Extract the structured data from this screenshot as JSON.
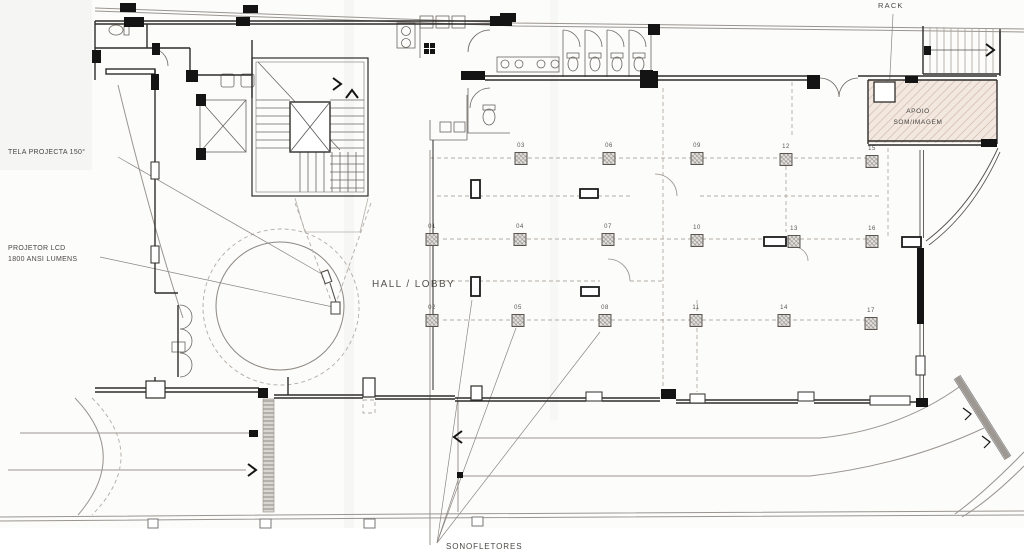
{
  "annotations": {
    "tela_projecta": "TELA PROJECTA 150°",
    "projetor_lcd": "PROJETOR LCD",
    "projetor_lumens": "1800 ANSI LUMENS",
    "hall_lobby": "HALL / LOBBY",
    "rack": "RACK",
    "apoio_line1": "APOIO",
    "apoio_line2": "SOM/IMAGEM",
    "sonofletores": "SONOFLETORES"
  },
  "speakers": [
    {
      "id": "01",
      "x": 432,
      "y": 239
    },
    {
      "id": "02",
      "x": 432,
      "y": 320
    },
    {
      "id": "03",
      "x": 521,
      "y": 158
    },
    {
      "id": "04",
      "x": 520,
      "y": 239
    },
    {
      "id": "05",
      "x": 518,
      "y": 320
    },
    {
      "id": "06",
      "x": 609,
      "y": 158
    },
    {
      "id": "07",
      "x": 608,
      "y": 239
    },
    {
      "id": "08",
      "x": 605,
      "y": 320
    },
    {
      "id": "09",
      "x": 697,
      "y": 158
    },
    {
      "id": "10",
      "x": 697,
      "y": 240
    },
    {
      "id": "11",
      "x": 696,
      "y": 320
    },
    {
      "id": "12",
      "x": 786,
      "y": 159
    },
    {
      "id": "13",
      "x": 794,
      "y": 241
    },
    {
      "id": "14",
      "x": 784,
      "y": 320
    },
    {
      "id": "15",
      "x": 872,
      "y": 161
    },
    {
      "id": "16",
      "x": 872,
      "y": 241
    },
    {
      "id": "17",
      "x": 871,
      "y": 323
    }
  ],
  "colors": {
    "wall": "#2f2d2b",
    "site_line": "#9a958f",
    "dashed_line": "#b3aca4",
    "apoio_hatch": "#cdb4a6",
    "ramp_hatch": "#8f8a84",
    "speaker_border": "#5a564f",
    "text": "#4a4743"
  }
}
